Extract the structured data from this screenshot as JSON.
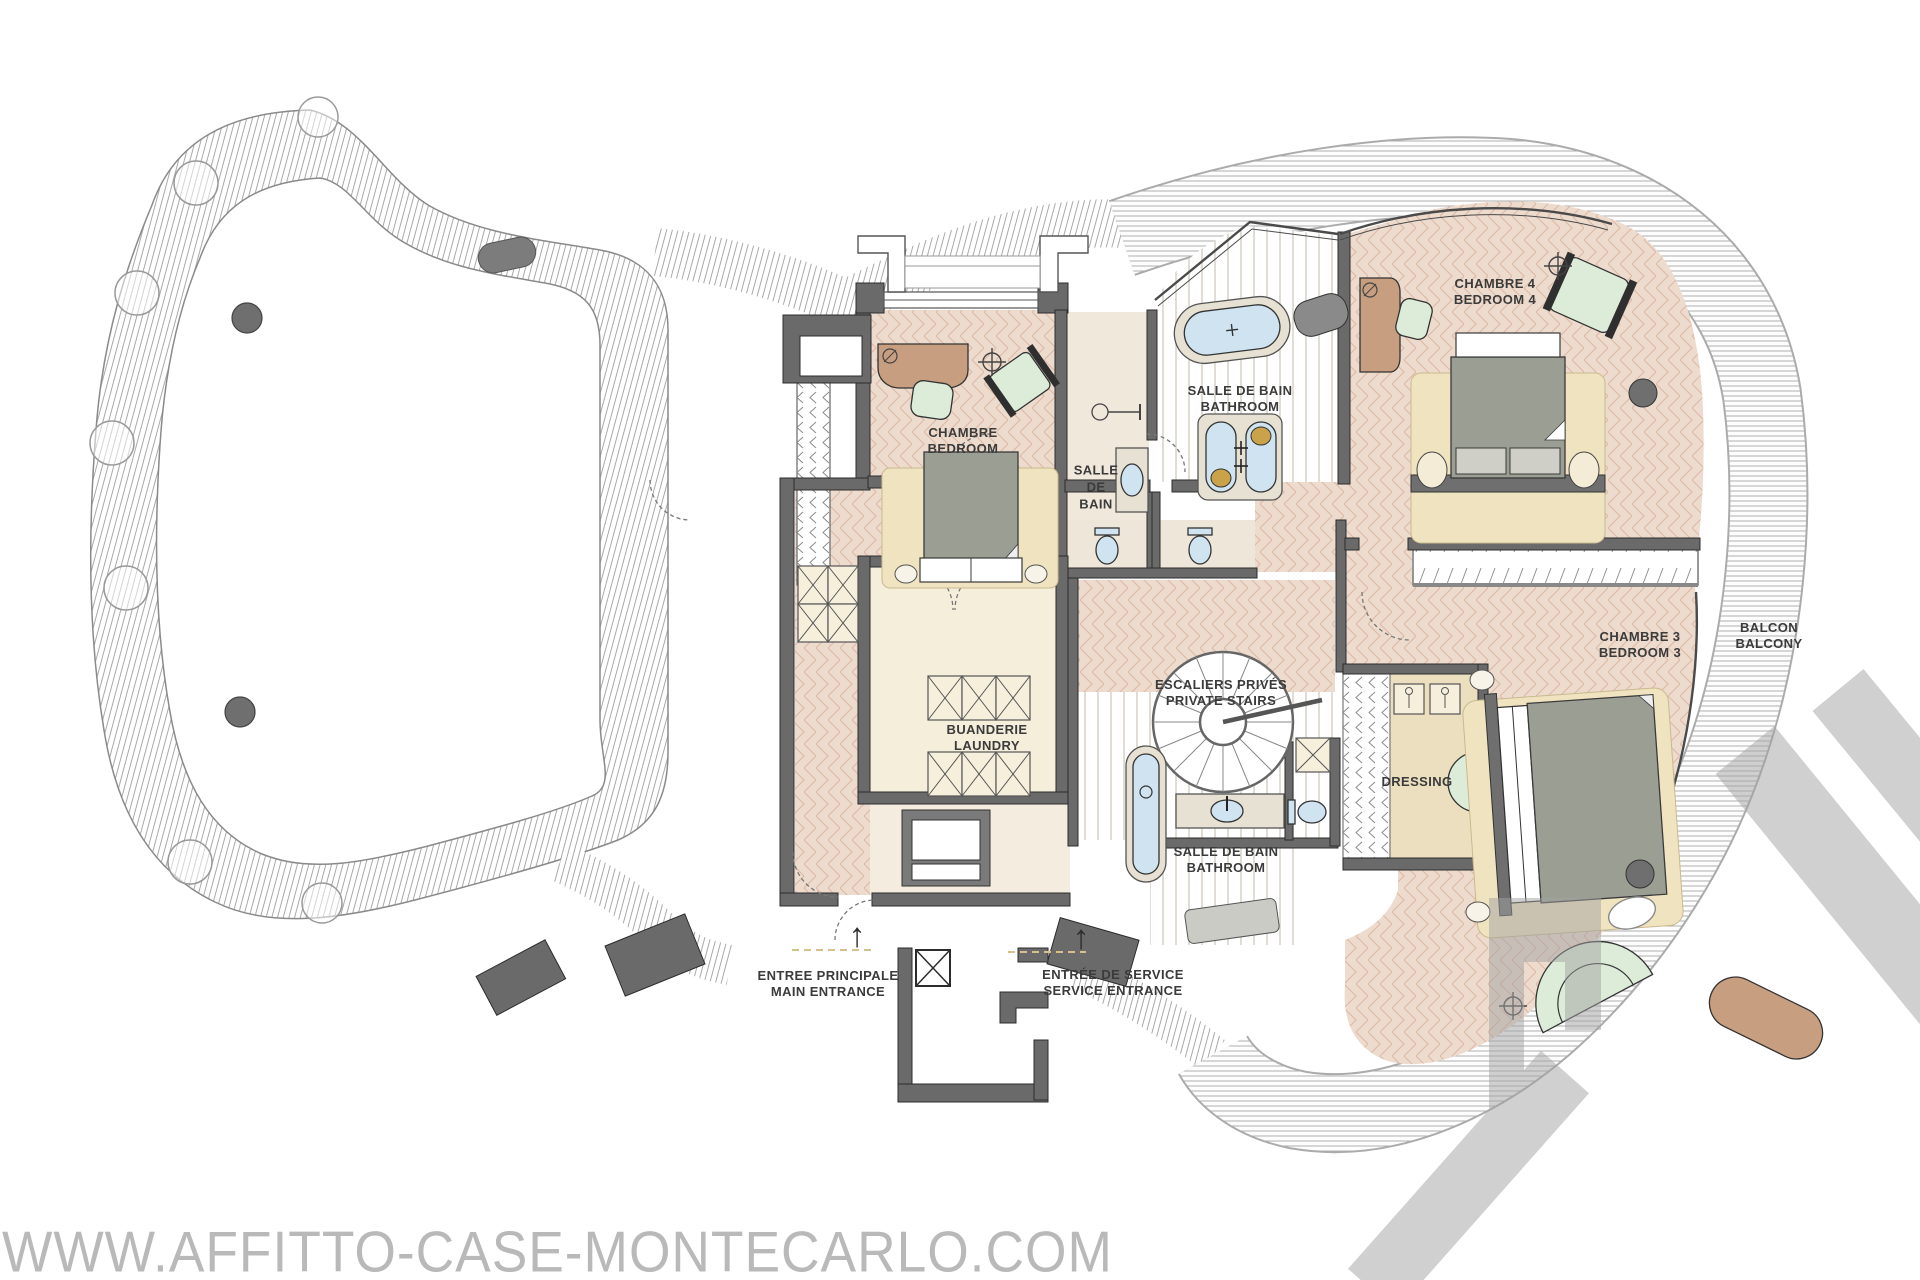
{
  "page": {
    "background": "#ffffff",
    "type": "apartment floor plan"
  },
  "watermark": {
    "site_text": "WWW.AFFITTO-CASE-MONTECARLO.COM",
    "color": "#b9b9b9",
    "logo_color": "#a2a2a2"
  },
  "icons": {
    "up_arrow": "↑"
  },
  "colors": {
    "wall": "#6a6a6a",
    "floor_herringbone": "#eddbce",
    "rug_beige": "#f0e3bf",
    "fixture_blue": "#cfe4f0",
    "furniture_mint": "#dcecd9",
    "furniture_tan": "#c79e7f",
    "cabinet_cream": "#f6efdc",
    "deck_line": "#9f9f9f",
    "label_text": "#3b3b3b"
  },
  "rooms": {
    "chambre": {
      "line1": "CHAMBRE",
      "line2": "BEDROOM"
    },
    "salle_de_bain_small": {
      "line1": "SALLE",
      "line2": "DE",
      "line3": "BAIN"
    },
    "bathroom_top": {
      "line1": "SALLE DE BAIN",
      "line2": "BATHROOM"
    },
    "chambre4": {
      "line1": "CHAMBRE 4",
      "line2": "BEDROOM 4"
    },
    "balcon": {
      "line1": "BALCON",
      "line2": "BALCONY"
    },
    "chambre3": {
      "line1": "CHAMBRE 3",
      "line2": "BEDROOM 3"
    },
    "escaliers": {
      "line1": "ESCALIERS PRIVÉS",
      "line2": "PRIVATE STAIRS"
    },
    "buanderie": {
      "line1": "BUANDERIE",
      "line2": "LAUNDRY"
    },
    "dressing": {
      "line1": "DRESSING"
    },
    "bathroom_lower": {
      "line1": "SALLE DE BAIN",
      "line2": "BATHROOM"
    },
    "entree_principale": {
      "line1": "ENTREE PRINCIPALE",
      "line2": "MAIN ENTRANCE"
    },
    "entree_service": {
      "line1": "ENTRÉE DE SERVICE",
      "line2": "SERVICE ENTRANCE"
    }
  }
}
